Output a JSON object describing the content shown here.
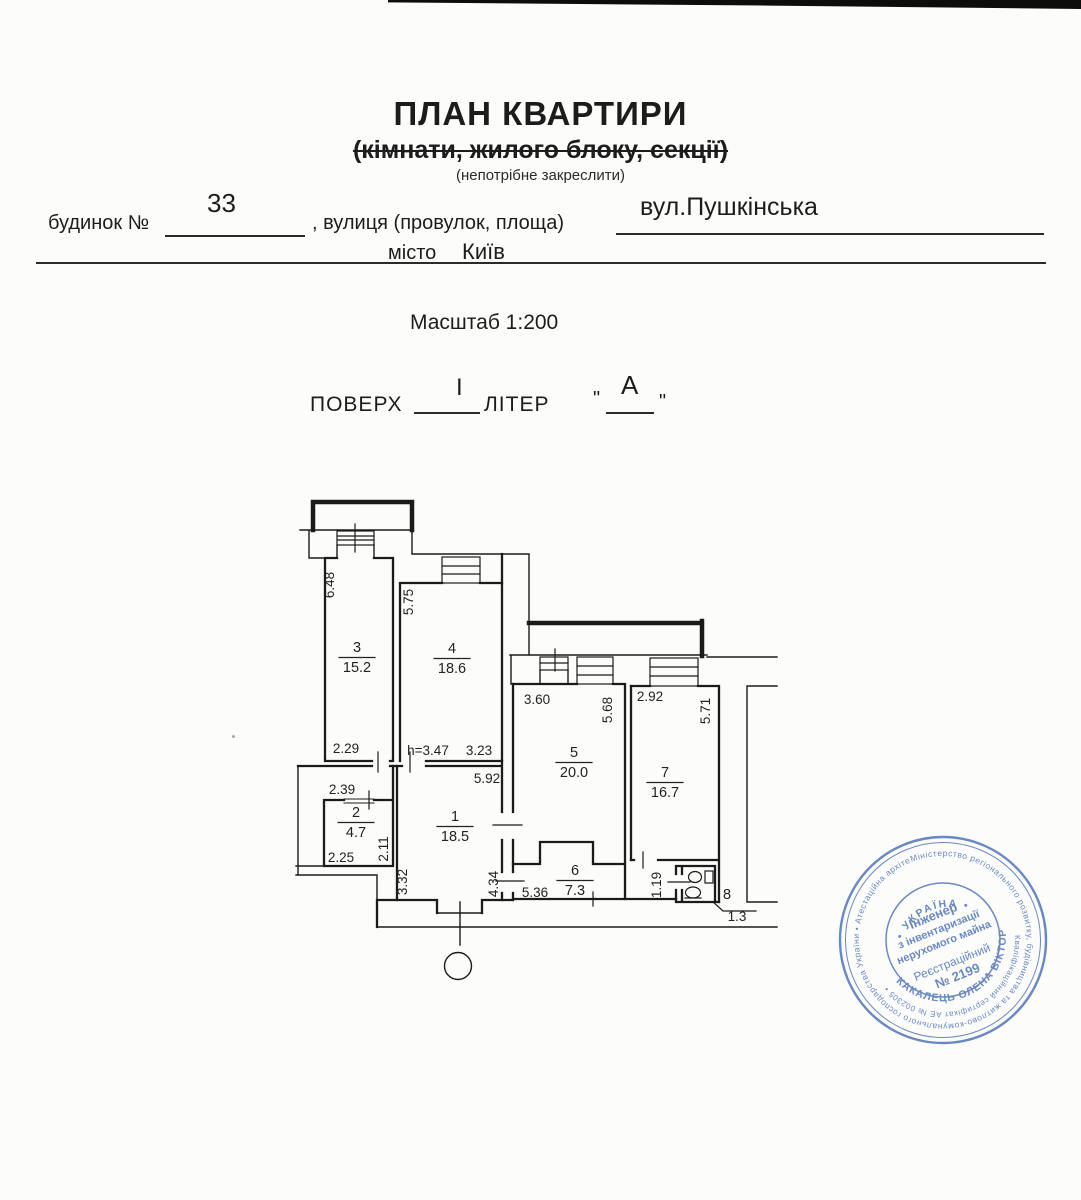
{
  "header": {
    "title": "ПЛАН КВАРТИРИ",
    "subtitle": "(кімнати, жилого блоку, секції)",
    "note": "(непотрібне закреслити)",
    "house_label": "будинок №",
    "house_value": "33",
    "street_label": ", вулиця (провулок, площа)",
    "street_value": "вул.Пушкінська",
    "city_label": "місто",
    "city_value": "Київ",
    "scale_label": "Масштаб 1:200",
    "floor_label": "ПОВЕРХ",
    "floor_value": "I",
    "letter_label": "ЛІТЕР",
    "letter_value": "А",
    "quote_open": "\"",
    "quote_close": "\""
  },
  "plan": {
    "rooms": [
      {
        "num": "1",
        "area": "18.5",
        "x": 455,
        "y": 821
      },
      {
        "num": "2",
        "area": "4.7",
        "x": 356,
        "y": 817
      },
      {
        "num": "3",
        "area": "15.2",
        "x": 357,
        "y": 652
      },
      {
        "num": "4",
        "area": "18.6",
        "x": 452,
        "y": 653
      },
      {
        "num": "5",
        "area": "20.0",
        "x": 574,
        "y": 757
      },
      {
        "num": "6",
        "area": "7.3",
        "x": 575,
        "y": 875
      },
      {
        "num": "7",
        "area": "16.7",
        "x": 665,
        "y": 777
      },
      {
        "num": "8",
        "area": null,
        "x": 727,
        "y": 899
      }
    ],
    "dims": [
      {
        "t": "6.48",
        "x": 334,
        "y": 585,
        "rot": true
      },
      {
        "t": "5.75",
        "x": 413,
        "y": 602,
        "rot": true
      },
      {
        "t": "2.11",
        "x": 388,
        "y": 849,
        "rot": true
      },
      {
        "t": "3.32",
        "x": 407,
        "y": 882,
        "rot": true
      },
      {
        "t": "4.34",
        "x": 498,
        "y": 884,
        "rot": true
      },
      {
        "t": "5.68",
        "x": 612,
        "y": 710,
        "rot": true
      },
      {
        "t": "5.71",
        "x": 710,
        "y": 711,
        "rot": true
      },
      {
        "t": "1.19",
        "x": 661,
        "y": 885,
        "rot": true
      },
      {
        "t": "2.29",
        "x": 346,
        "y": 753,
        "rot": false
      },
      {
        "t": "h=3.47",
        "x": 428,
        "y": 755,
        "rot": false
      },
      {
        "t": "3.23",
        "x": 479,
        "y": 755,
        "rot": false
      },
      {
        "t": "5.92",
        "x": 487,
        "y": 783,
        "rot": false
      },
      {
        "t": "2.39",
        "x": 342,
        "y": 794,
        "rot": false
      },
      {
        "t": "2.25",
        "x": 341,
        "y": 862,
        "rot": false
      },
      {
        "t": "5.36",
        "x": 535,
        "y": 897,
        "rot": false
      },
      {
        "t": "3.60",
        "x": 537,
        "y": 704,
        "rot": false
      },
      {
        "t": "2.92",
        "x": 650,
        "y": 701,
        "rot": false
      },
      {
        "t": "1.3",
        "x": 737,
        "y": 921,
        "rot": false
      }
    ]
  },
  "stamp": {
    "country": "• УКРАЇНА •",
    "ring_outer": "Міністерство регіонального розвитку, будівництва та житлово-комунального господарства України • Атестаційна архітектурно-будівельна комісія •",
    "cert_arc": "Кваліфікаційний сертифікат АЕ № 002305 •",
    "name_arc": "КАКАЛЕЦЬ ОЛЕНА ВІКТОРІВНА",
    "line1": "Інженер",
    "line2": "з інвентаризації",
    "line3": "нерухомого майна",
    "line4": "Реєстраційний",
    "line5": "№ 2199",
    "color": "#4a6fb8"
  }
}
